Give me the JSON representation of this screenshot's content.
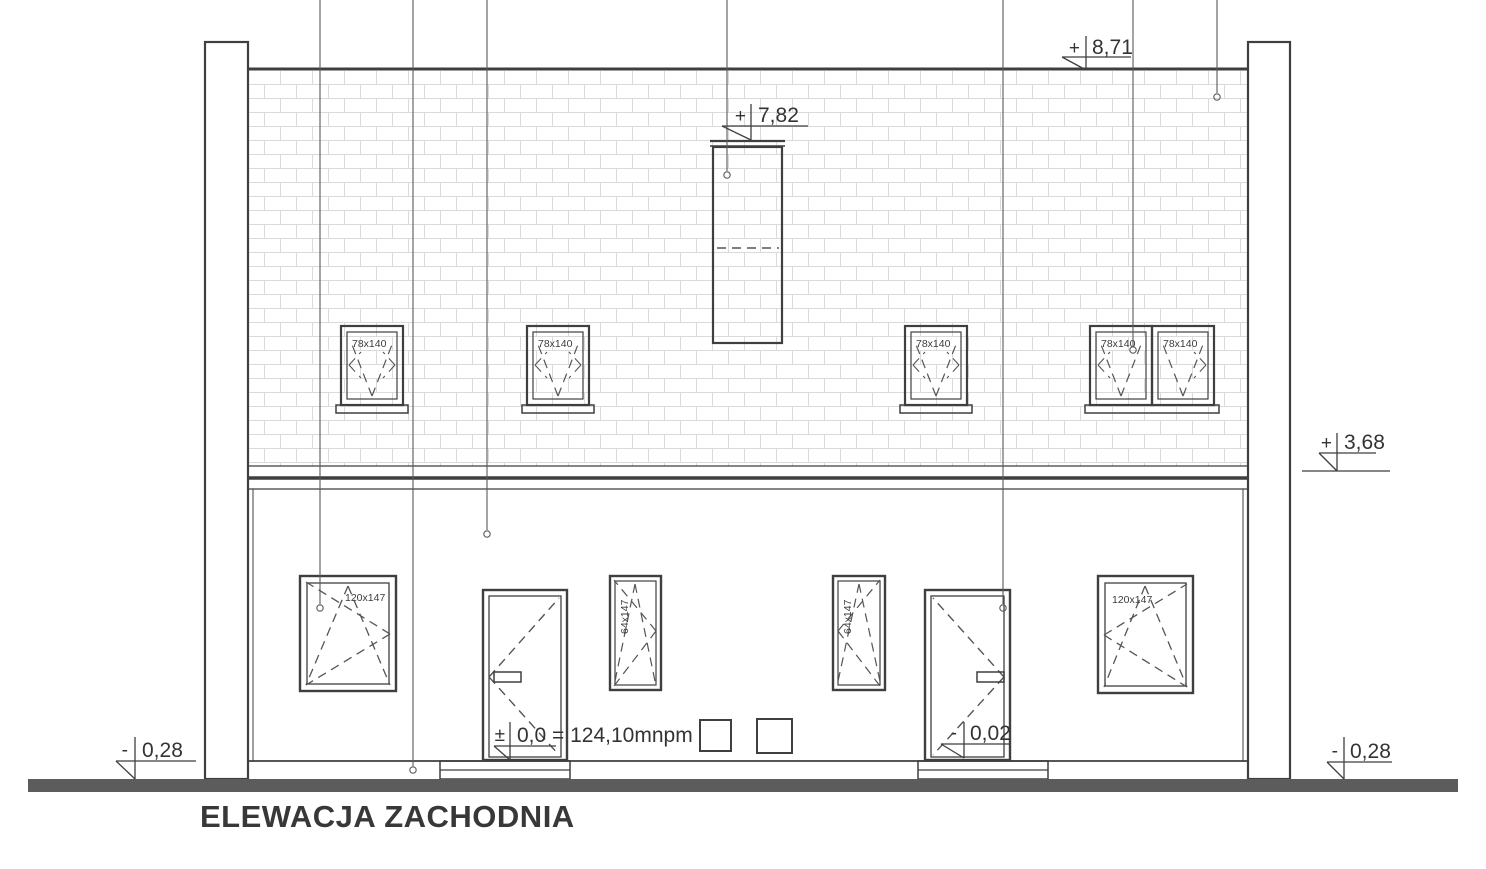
{
  "title": "ELEWACJA ZACHODNIA",
  "elevation_markers": {
    "ridge": {
      "sign": "+",
      "value": "8,71"
    },
    "chimney_top": {
      "sign": "+",
      "value": "7,82"
    },
    "eaves_right": {
      "sign": "+",
      "value": "3,68"
    },
    "terrain_left": {
      "sign": "-",
      "value": "0,28"
    },
    "entrance_zero": {
      "sign": "±",
      "value": "0,0 = 124,10mnpm"
    },
    "right_door_threshold": {
      "sign": "-",
      "value": "0,02"
    },
    "terrain_right": {
      "sign": "-",
      "value": "0,28"
    }
  },
  "labels": {
    "attic_window": "78x140",
    "ground_large_window": "120x147",
    "ground_narrow_window": "64x147"
  },
  "colors": {
    "line": "#3f3f3f",
    "ground_bar": "#5c5c5c",
    "brick": "#b9b9b9"
  }
}
